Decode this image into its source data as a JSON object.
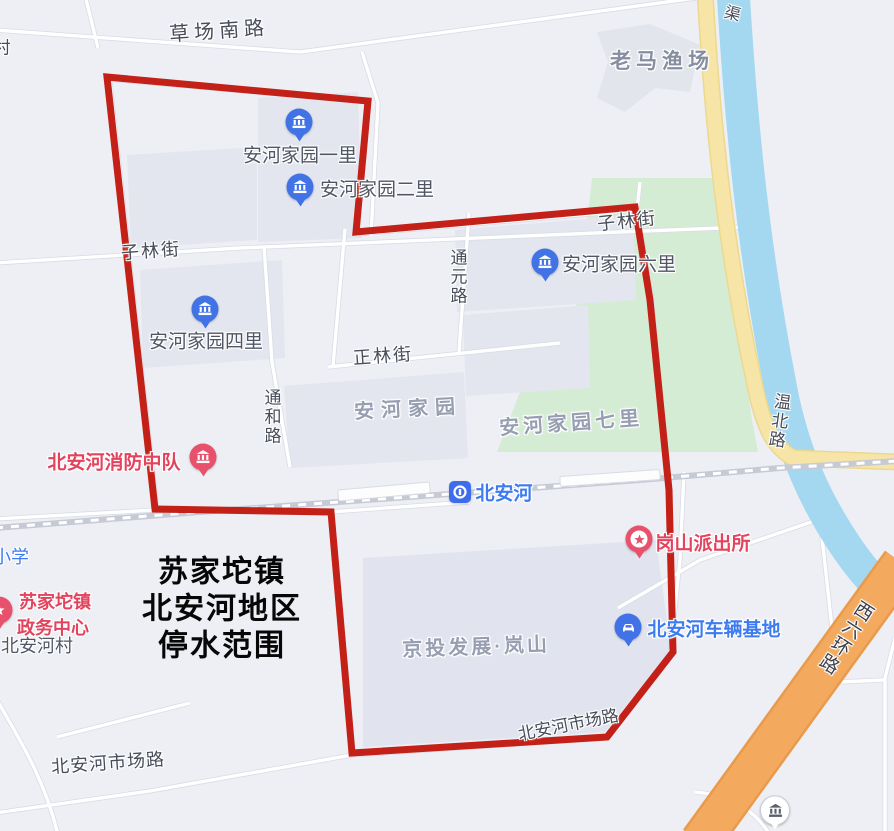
{
  "overlay_title": {
    "line1": "苏家坨镇",
    "line2": "北安河地区",
    "line3": "停水范围"
  },
  "road_labels": {
    "cun_partial": "村",
    "caochang_south_rd": "草场南路",
    "qu_partial": "渠",
    "zilin_street_west": "子林街",
    "zilin_street_east": "子林街",
    "tongyuan_rd": "通元路",
    "zhenglin_street": "正林街",
    "tonghe_rd": "通和路",
    "wenbei_rd": "温北路",
    "market_rd_west": "北安河市场路",
    "market_rd_east": "北安河市场路",
    "west_6th_ring_rd": "西六环路"
  },
  "area_labels": {
    "laoma_fishery": "老马渔场",
    "anhe_jiayuan": "安河家园",
    "anhe_jiayuan_qili": "安河家园七里",
    "jingtou_lanshan": "京投发展·岚山",
    "beianhe_village": "北安河村",
    "xiaoxue_partial": "小学"
  },
  "pois": {
    "yili": {
      "label": "安河家园一里"
    },
    "erli": {
      "label": "安河家园二里"
    },
    "sili": {
      "label": "安河家园四里"
    },
    "liuli": {
      "label": "安河家园六里"
    },
    "fire": {
      "label": "北安河消防中队"
    },
    "station": {
      "label": "北安河"
    },
    "police": {
      "label": "岗山派出所"
    },
    "gov_line1": "苏家坨镇",
    "gov_line2": "政务中心",
    "depot": {
      "label": "北安河车辆基地"
    }
  },
  "colors": {
    "boundary_red": "#c32017",
    "park_green": "#d5ecd4",
    "canal_blue": "#a3d8f0",
    "arterial_yellow": "#f7e5a7",
    "highway_orange": "#f3aa5e",
    "poi_blue": "#3d7bf0",
    "poi_red": "#e4435e",
    "background": "#edeff5"
  }
}
